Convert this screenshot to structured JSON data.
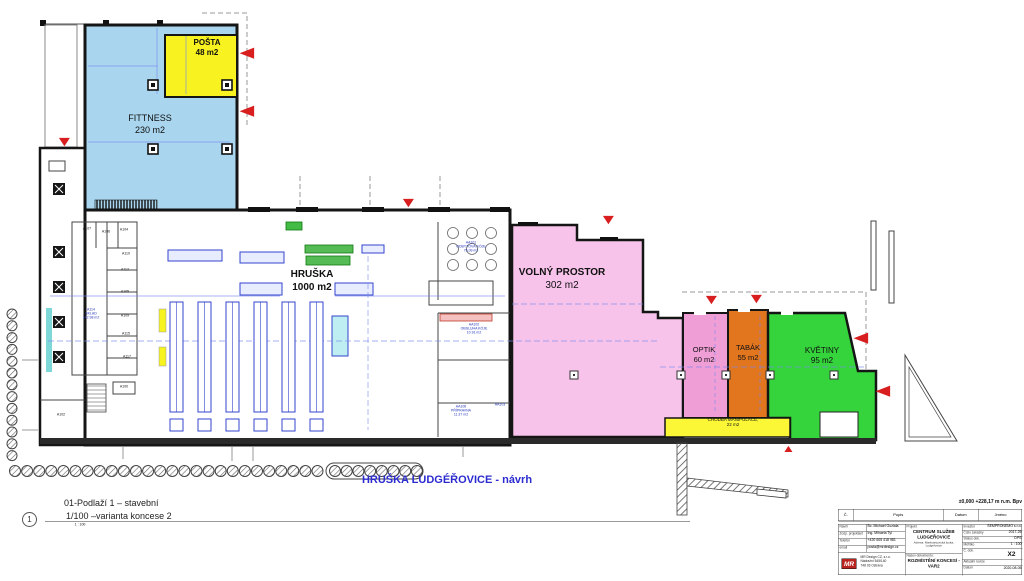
{
  "zones": {
    "fitness": {
      "label": "FITTNESS",
      "area": "230 m2",
      "color": "#a9d6ee"
    },
    "posta": {
      "label": "POŠTA",
      "area": "48 m2",
      "color": "#f8f320"
    },
    "hruska": {
      "label": "HRUŠKA",
      "area": "1000 m2",
      "color": "#ffffff"
    },
    "volny": {
      "label": "VOLNÝ PROSTOR",
      "area": "302 m2",
      "color": "#f7c3ea"
    },
    "optik": {
      "label": "OPTIK",
      "area": "60 m2",
      "color": "#f09ed6"
    },
    "tabak": {
      "label": "TABÁK",
      "area": "55 m2",
      "color": "#e2761f"
    },
    "kvetiny": {
      "label": "KVĚTINY",
      "area": "95 m2",
      "color": "#35d43c"
    },
    "chodba": {
      "label": "CHODBA MANIPULACE,",
      "area": "22 m2",
      "color": "#fbf736"
    }
  },
  "rooms": {
    "a107": "A107",
    "a106": "A106",
    "a104": "A104",
    "a110": "A110",
    "a112": "A112",
    "a105": "A105",
    "a109": "A109",
    "a115": "A115",
    "a117": "A117",
    "a100": "A100",
    "a102": "A102"
  },
  "interior": {
    "sklad": [
      "A114",
      "SKLAD",
      "142.98 m2"
    ],
    "aa101": [
      "AA101",
      "ODBYTOVÁ KÓJE",
      "76.09 m2"
    ],
    "aa102": [
      "AA102",
      "OBSLUHA KÓJE",
      "10.91 m2"
    ],
    "aa106": [
      "AA106",
      "PŘÍPRAVNA",
      "11.37 m2"
    ],
    "aa103": "AA103"
  },
  "footer": {
    "line1": "01-Podlaží 1 – stavební",
    "line2": "1/100 –varianta koncese 2",
    "bubble": "1",
    "scale_note": "1 : 100",
    "drawing_title": "HRUŠKA LUDGÉŘOVICE - návrh"
  },
  "titleblock": {
    "elevation": "±0,000 +228,17  m n.m. Bpv",
    "rev": {
      "c": "Č.",
      "popis": "Popis",
      "datum": "Datum",
      "jmeno": "Jméno"
    },
    "left": {
      "navrh_label": "Návrh",
      "navrh": "Bc. Michael Guziala",
      "zodp_label": "Zodp. projektant",
      "zodp": "Ing. Mihaela Tyl",
      "tel_label": "Telefon",
      "tel": "+420 605 418 981",
      "email_label": "email",
      "email": "posta@mrdesign.cz",
      "logo": "MR",
      "firm1": "MR Design CZ, s.r.o.",
      "firm2": "Nádražní 545/140",
      "firm3": "748 03 Ostrava"
    },
    "mid": {
      "projekt_label": "Projekt",
      "projekt1": "CENTRUM SLUŽEB",
      "projekt2": "LUDGEŘOVICE",
      "adresa": "Adresa: Markvartovická louka, Ludgeřovice",
      "nazev_label": "Název dokumentu:",
      "nazev1": "ROZMÍSTĚNÍ KONCESÍ -",
      "nazev2": "VAR2"
    },
    "right": {
      "investor_label": "Investor",
      "investor": "SEMPRONEMO s.r.o.",
      "zakazka_label": "Číslo zakázky",
      "zakazka": "2017-25",
      "status_label": "Status dok.",
      "status": "DPS",
      "meritko_label": "Měřítko",
      "meritko": "1 : 100",
      "cdok_label": "Č. dok.",
      "cdok": "X2",
      "revize_label": "Aktuální revize",
      "datum_label": "Datum",
      "datum": "2020-08-05"
    }
  },
  "landscape": {
    "vertical_shrubs": 13,
    "horizontal_shrubs": 26,
    "ringed_shrubs": 8
  },
  "colors": {
    "arrow_red": "#d81e1e",
    "cad_blue": "#2233bb",
    "dim_blue": "#7788ee",
    "wall": "#151515"
  }
}
